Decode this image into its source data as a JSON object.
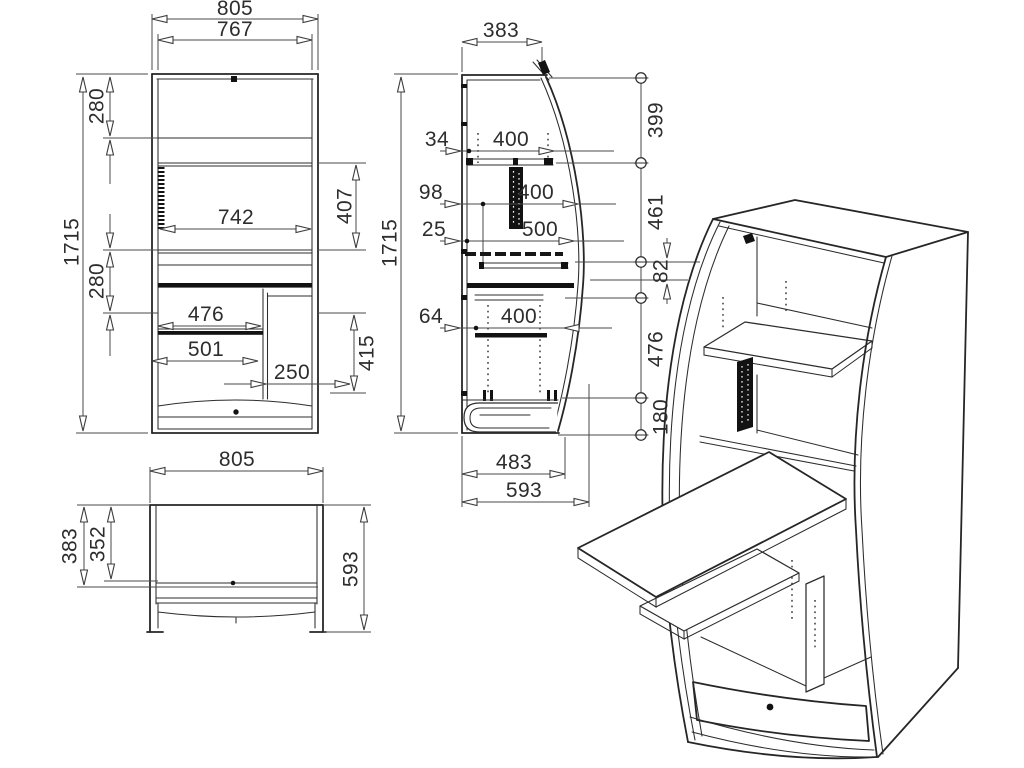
{
  "colors": {
    "ink": "#262626",
    "paper": "#ffffff"
  },
  "front_view": {
    "width_top": "805",
    "width_opening": "767",
    "upper_section": "280",
    "mid_section": "280",
    "total_height": "1715",
    "shelf_width": "742",
    "upper_right_gap": "407",
    "shelf_lower": "476",
    "desk_width": "501",
    "partition_offset": "250",
    "lower_right_gap": "415"
  },
  "plan_view": {
    "width": "805",
    "depth": "383",
    "depth_inner": "352",
    "depth_total": "593"
  },
  "side_view": {
    "depth_top": "383",
    "total_height": "1715",
    "offset_a": "34",
    "span_a": "400",
    "offset_b": "98",
    "span_b": "400",
    "offset_c": "25",
    "span_c": "500",
    "offset_d": "64",
    "span_d": "400",
    "datum_a": "399",
    "datum_b": "461",
    "datum_c": "82",
    "datum_d": "476",
    "datum_e": "180",
    "base_inner": "483",
    "base_depth": "593"
  }
}
